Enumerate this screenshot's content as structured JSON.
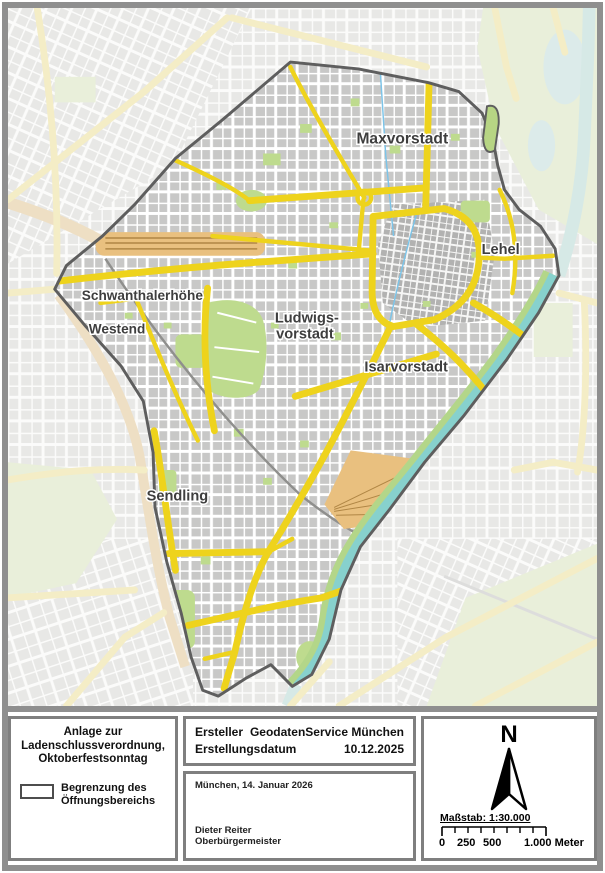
{
  "map": {
    "districts": [
      {
        "name": "Maxvorstadt"
      },
      {
        "name": "Lehel"
      },
      {
        "name": "Schwanthalerhöhe"
      },
      {
        "name": "Westend"
      },
      {
        "name": "Ludwigs-"
      },
      {
        "name": "vorstadt"
      },
      {
        "name": "Isarvorstadt"
      },
      {
        "name": "Sendling"
      }
    ],
    "colors": {
      "boundary": "#5e5e5e",
      "road_major": "#eed31c",
      "road_faded": "#f4edc6",
      "river": "#87d1cd",
      "park": "#bedb8e",
      "blocks_inside": "#c8c8c7",
      "blocks_outside": "#e8e8e6",
      "railway": "#e9c07f"
    }
  },
  "panel": {
    "title_block": {
      "line1": "Anlage zur",
      "line2": "Ladenschlussverordnung,",
      "line3": "Oktoberfestsonntag"
    },
    "legend": {
      "item_line1": "Begrenzung des",
      "item_line2": "Öffnungsbereichs"
    },
    "meta": {
      "creator_label": "Ersteller",
      "creator_value": "GeodatenService München",
      "date_label": "Erstellungsdatum",
      "date_value": "10.12.2025"
    },
    "signature": {
      "place_date": "München, 14. Januar 2026",
      "name": "Dieter Reiter",
      "title": "Oberbürgermeister"
    },
    "compass": {
      "north_label": "N"
    },
    "scale": {
      "label": "Maßstab: 1:30.000",
      "tick_0": "0",
      "tick_250": "250",
      "tick_500": "500",
      "tick_end": "1.000 Meter"
    }
  }
}
